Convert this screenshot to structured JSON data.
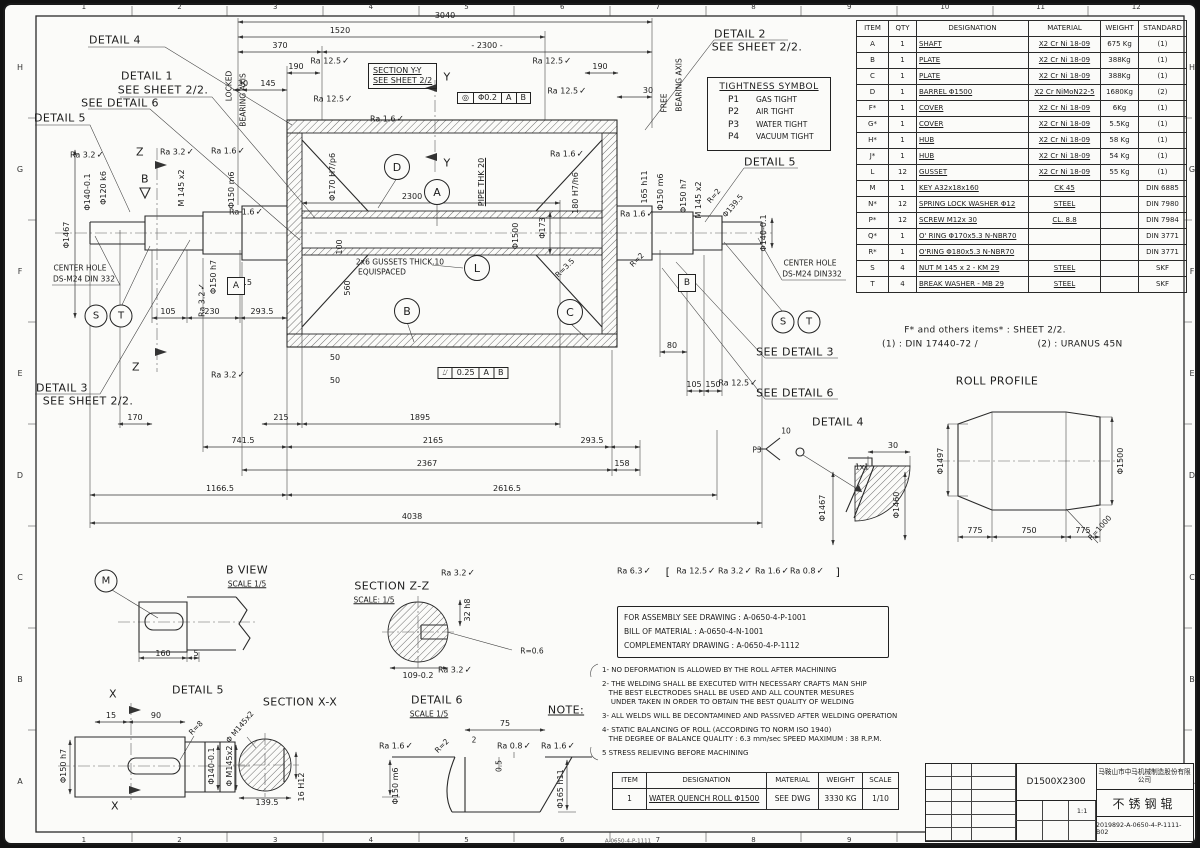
{
  "zones": {
    "cols": [
      "1",
      "2",
      "3",
      "4",
      "5",
      "6",
      "7",
      "8",
      "9",
      "10",
      "11",
      "12"
    ],
    "rows": [
      "H",
      "G",
      "F",
      "E",
      "D",
      "C",
      "B",
      "A"
    ]
  },
  "parts_table": {
    "headers": [
      "ITEM",
      "QTY",
      "DESIGNATION",
      "MATERIAL",
      "WEIGHT",
      "STANDARD"
    ],
    "rows": [
      [
        "A",
        "1",
        "SHAFT",
        "X2 Cr Ni 18-09",
        "675 Kg",
        "(1)"
      ],
      [
        "B",
        "1",
        "PLATE",
        "X2 Cr Ni 18-09",
        "388Kg",
        "(1)"
      ],
      [
        "C",
        "1",
        "PLATE",
        "X2 Cr Ni 18-09",
        "388Kg",
        "(1)"
      ],
      [
        "D",
        "1",
        "BARREL Φ1500",
        "X2 Cr NiMoN22-5",
        "1680Kg",
        "(2)"
      ],
      [
        "F*",
        "1",
        "COVER",
        "X2 Cr Ni 18-09",
        "6Kg",
        "(1)"
      ],
      [
        "G*",
        "1",
        "COVER",
        "X2 Cr Ni 18-09",
        "5.5Kg",
        "(1)"
      ],
      [
        "H*",
        "1",
        "HUB",
        "X2 Cr Ni 18-09",
        "58 Kg",
        "(1)"
      ],
      [
        "J*",
        "1",
        "HUB",
        "X2 Cr Ni 18-09",
        "54 Kg",
        "(1)"
      ],
      [
        "L",
        "12",
        "GUSSET",
        "X2 Cr Ni 18-09",
        "55 Kg",
        "(1)"
      ],
      [
        "M",
        "1",
        "KEY  A32x18x160",
        "CK 45",
        "",
        "DIN 6885"
      ],
      [
        "N*",
        "12",
        "SPRING LOCK WASHER Φ12",
        "STEEL",
        "",
        "DIN 7980"
      ],
      [
        "P*",
        "12",
        "SCREW M12x 30",
        "CL. 8.8",
        "",
        "DIN 7984"
      ],
      [
        "Q*",
        "1",
        "O' RING Φ170x5.3 N-NBR70",
        "",
        "",
        "DIN 3771"
      ],
      [
        "R*",
        "1",
        "O'RING Φ180x5.3 N-NBR70",
        "",
        "",
        "DIN 3771"
      ],
      [
        "S",
        "4",
        "NUT M 145 x 2 - KM 29",
        "STEEL",
        "",
        "SKF"
      ],
      [
        "T",
        "4",
        "BREAK WASHER - MB 29",
        "STEEL",
        "",
        "SKF"
      ]
    ]
  },
  "tightness": {
    "title": "TIGHTNESS SYMBOL",
    "items": [
      [
        "P1",
        "GAS TIGHT"
      ],
      [
        "P2",
        "AIR TIGHT"
      ],
      [
        "P3",
        "WATER TIGHT"
      ],
      [
        "P4",
        "VACUUM TIGHT"
      ]
    ]
  },
  "main_view": {
    "section_box": [
      "SECTION Y-Y",
      "SEE SHEET 2/2"
    ]
  },
  "assembly_box": {
    "lines": [
      "FOR ASSEMBLY SEE DRAWING : A-0650-4-P-1001",
      "BILL OF MATERIAL : A-0650-4-N-1001",
      "COMPLEMENTARY DRAWING : A-0650-4-P-1112"
    ]
  },
  "notes": {
    "paragraphs": [
      [
        "1- NO DEFORMATION IS ALLOWED BY THE ROLL AFTER MACHINING"
      ],
      [
        "2- THE WELDING SHALL BE EXECUTED WITH NECESSARY CRAFTS MAN SHIP",
        "   THE BEST ELECTRODES SHALL BE USED AND ALL COUNTER MESURES",
        "    UNDER TAKEN IN ORDER TO OBTAIN THE BEST QUALITY OF WELDING"
      ],
      [
        "3- ALL WELDS WILL BE DECONTAMINED AND PASSIVED AFTER WELDING OPERATION"
      ],
      [
        "4- STATIC BALANCING OF ROLL (ACCORDING TO NORM ISO 1940)",
        "   THE DEGREE OF BALANCE QUALITY : 6.3 mm/sec SPEED MAXIMUM : 38 R.P.M."
      ],
      [
        "5 STRESS RELIEVING BEFORE MACHINING"
      ]
    ]
  },
  "item_table": {
    "headers": [
      "ITEM",
      "DESIGNATION",
      "MATERIAL",
      "WEIGHT",
      "SCALE"
    ],
    "rows": [
      [
        "1",
        "WATER QUENCH ROLL Φ1500",
        "SEE DWG",
        "3330 KG",
        "1/10"
      ]
    ]
  },
  "title_block": {
    "company": "马鞍山市中马机械制造股份有限公司",
    "model": "D1500X2300",
    "product": "不锈钢辊",
    "number": "2019892-A-0650-4-P-1111-B02",
    "scale": "1:1"
  },
  "symbols": {
    "balloons": [
      {
        "t": "D",
        "x": 397,
        "y": 167
      },
      {
        "t": "A",
        "x": 437,
        "y": 192
      },
      {
        "t": "L",
        "x": 477,
        "y": 268
      },
      {
        "t": "B",
        "x": 407,
        "y": 311
      },
      {
        "t": "C",
        "x": 570,
        "y": 312
      },
      {
        "t": "S",
        "x": 96,
        "y": 316,
        "s": 1
      },
      {
        "t": "T",
        "x": 121,
        "y": 316,
        "s": 1
      },
      {
        "t": "S",
        "x": 783,
        "y": 322,
        "s": 1
      },
      {
        "t": "T",
        "x": 809,
        "y": 322,
        "s": 1
      },
      {
        "t": "M",
        "x": 106,
        "y": 581,
        "s": 1
      }
    ],
    "datums": [
      {
        "t": "A",
        "x": 236,
        "y": 286
      },
      {
        "t": "B",
        "x": 687,
        "y": 283
      }
    ],
    "frames": [
      {
        "cells": [
          "◎",
          "Φ0.2",
          "A",
          "B"
        ],
        "x": 494,
        "y": 98
      },
      {
        "cells": [
          "⌰",
          "0.25",
          "A",
          "B"
        ],
        "x": 473,
        "y": 373
      }
    ]
  },
  "annotations": [
    {
      "t": "DETAIL 4",
      "x": 115,
      "y": 40,
      "c": "lbl"
    },
    {
      "t": "DETAIL 1",
      "x": 147,
      "y": 76,
      "c": "lbl"
    },
    {
      "t": "SEE SHEET 2/2.",
      "x": 163,
      "y": 90,
      "c": "lbl"
    },
    {
      "t": "SEE DETAIL 6",
      "x": 120,
      "y": 103,
      "c": "lbl"
    },
    {
      "t": "DETAIL 5",
      "x": 60,
      "y": 118,
      "c": "lbl"
    },
    {
      "t": "DETAIL 3",
      "x": 62,
      "y": 388,
      "c": "lbl"
    },
    {
      "t": "SEE  SHEET 2/2.",
      "x": 88,
      "y": 401,
      "c": "lbl"
    },
    {
      "t": "LOCKED",
      "x": 229,
      "y": 86,
      "r": -90,
      "c": "sm"
    },
    {
      "t": "BEARING AXIS",
      "x": 243,
      "y": 100,
      "r": -90,
      "c": "sm"
    },
    {
      "t": "Z",
      "x": 140,
      "y": 152,
      "c": "lbl"
    },
    {
      "t": "Z",
      "x": 136,
      "y": 367,
      "c": "lbl"
    },
    {
      "t": "B",
      "x": 145,
      "y": 179,
      "c": "lbl"
    },
    {
      "t": "CENTER HOLE",
      "x": 80,
      "y": 268,
      "c": "sm"
    },
    {
      "t": "DS-M24 DIN 332",
      "x": 84,
      "y": 279,
      "c": "sm"
    },
    {
      "t": "DETAIL 2",
      "x": 740,
      "y": 34,
      "c": "lbl"
    },
    {
      "t": "SEE SHEET 2/2.",
      "x": 757,
      "y": 47,
      "c": "lbl"
    },
    {
      "t": "DETAIL 5",
      "x": 770,
      "y": 162,
      "c": "lbl"
    },
    {
      "t": "FREE",
      "x": 664,
      "y": 103,
      "r": -90,
      "c": "sm"
    },
    {
      "t": "BEARING AXIS",
      "x": 679,
      "y": 85,
      "r": -90,
      "c": "sm"
    },
    {
      "t": "CENTER HOLE",
      "x": 810,
      "y": 263,
      "c": "sm"
    },
    {
      "t": "DS-M24 DIN332",
      "x": 812,
      "y": 274,
      "c": "sm"
    },
    {
      "t": "SEE DETAIL 3",
      "x": 795,
      "y": 352,
      "c": "lbl"
    },
    {
      "t": "SEE DETAIL 6",
      "x": 795,
      "y": 393,
      "c": "lbl"
    },
    {
      "t": "3040",
      "x": 445,
      "y": 16
    },
    {
      "t": "1520",
      "x": 340,
      "y": 31
    },
    {
      "t": "370",
      "x": 280,
      "y": 46
    },
    {
      "t": "- 2300 -",
      "x": 487,
      "y": 46
    },
    {
      "t": "190",
      "x": 296,
      "y": 67
    },
    {
      "t": "190",
      "x": 600,
      "y": 67
    },
    {
      "t": "30",
      "x": 243,
      "y": 84
    },
    {
      "t": "145",
      "x": 268,
      "y": 84
    },
    {
      "t": "30",
      "x": 648,
      "y": 91
    },
    {
      "t": "Ra 12.5",
      "x": 330,
      "y": 62,
      "c": "ra"
    },
    {
      "t": "Ra 12.5",
      "x": 552,
      "y": 62,
      "c": "ra"
    },
    {
      "t": "Ra 12.5",
      "x": 333,
      "y": 100,
      "c": "ra"
    },
    {
      "t": "Ra 12.5",
      "x": 567,
      "y": 92,
      "c": "ra"
    },
    {
      "t": "Ra 1.6",
      "x": 387,
      "y": 120,
      "c": "ra"
    },
    {
      "t": "Ra 1.6",
      "x": 567,
      "y": 155,
      "c": "ra"
    },
    {
      "t": "Y",
      "x": 447,
      "y": 77,
      "c": "lbl"
    },
    {
      "t": "Y",
      "x": 447,
      "y": 163,
      "c": "lbl"
    },
    {
      "t": "Φ1467",
      "x": 67,
      "y": 235,
      "r": -90
    },
    {
      "t": "Φ140-0.1",
      "x": 88,
      "y": 192,
      "r": -90
    },
    {
      "t": "Φ120 k6",
      "x": 104,
      "y": 188,
      "r": -90
    },
    {
      "t": "M 145 x2",
      "x": 182,
      "y": 188,
      "r": -90
    },
    {
      "t": "Φ150 m6",
      "x": 232,
      "y": 190,
      "r": -90
    },
    {
      "t": "Φ150 h7",
      "x": 214,
      "y": 277,
      "r": -90
    },
    {
      "t": "Ra 3.2",
      "x": 87,
      "y": 156,
      "c": "ra"
    },
    {
      "t": "Ra 3.2",
      "x": 177,
      "y": 153,
      "c": "ra"
    },
    {
      "t": "Ra 1.6",
      "x": 228,
      "y": 152,
      "c": "ra"
    },
    {
      "t": "Ra 3.2",
      "x": 203,
      "y": 300,
      "r": -90,
      "c": "ra"
    },
    {
      "t": "Ra 1.6",
      "x": 246,
      "y": 213,
      "c": "ra"
    },
    {
      "t": "Φ170 H7/p6",
      "x": 333,
      "y": 177,
      "r": -90
    },
    {
      "t": "PIPE THK 20",
      "x": 482,
      "y": 182,
      "r": -90,
      "c": "u"
    },
    {
      "t": "Φ1500",
      "x": 516,
      "y": 236,
      "r": -90
    },
    {
      "t": "Φ173",
      "x": 543,
      "y": 228,
      "r": -90
    },
    {
      "t": "180 H7/h6",
      "x": 576,
      "y": 193,
      "r": -90
    },
    {
      "t": "165 h11",
      "x": 645,
      "y": 187,
      "r": -90
    },
    {
      "t": "Φ150 m6",
      "x": 661,
      "y": 192,
      "r": -90
    },
    {
      "t": "Φ150 h7",
      "x": 684,
      "y": 196,
      "r": -90
    },
    {
      "t": "M 145 x2",
      "x": 699,
      "y": 200,
      "r": -90
    },
    {
      "t": "R=2",
      "x": 714,
      "y": 196,
      "r": -50,
      "c": "sm"
    },
    {
      "t": "Φ139.5",
      "x": 733,
      "y": 206,
      "r": -50,
      "c": "sm"
    },
    {
      "t": "Φ140-0.1",
      "x": 764,
      "y": 233,
      "r": -90
    },
    {
      "t": "R=3.5",
      "x": 565,
      "y": 268,
      "r": -45,
      "c": "sm"
    },
    {
      "t": "R=2",
      "x": 637,
      "y": 260,
      "r": -45,
      "c": "sm"
    },
    {
      "t": "Ra 1.6",
      "x": 637,
      "y": 215,
      "c": "ra"
    },
    {
      "t": "2300",
      "x": 412,
      "y": 197
    },
    {
      "t": "36.5",
      "x": 243,
      "y": 283
    },
    {
      "t": "100",
      "x": 340,
      "y": 247,
      "r": -90
    },
    {
      "t": "560",
      "x": 348,
      "y": 288,
      "r": -90
    },
    {
      "t": "2x6 GUSSETS THICK.10",
      "x": 400,
      "y": 262,
      "c": "sm"
    },
    {
      "t": "EQUISPACED",
      "x": 382,
      "y": 272,
      "c": "sm"
    },
    {
      "t": "50",
      "x": 335,
      "y": 358
    },
    {
      "t": "50",
      "x": 335,
      "y": 381
    },
    {
      "t": "105",
      "x": 168,
      "y": 312
    },
    {
      "t": "230",
      "x": 212,
      "y": 312
    },
    {
      "t": "293.5",
      "x": 262,
      "y": 312
    },
    {
      "t": "170",
      "x": 135,
      "y": 418
    },
    {
      "t": "215",
      "x": 281,
      "y": 418
    },
    {
      "t": "1895",
      "x": 420,
      "y": 418
    },
    {
      "t": "741.5",
      "x": 243,
      "y": 441
    },
    {
      "t": "2165",
      "x": 433,
      "y": 441
    },
    {
      "t": "293.5",
      "x": 592,
      "y": 441
    },
    {
      "t": "2367",
      "x": 427,
      "y": 464
    },
    {
      "t": "158",
      "x": 622,
      "y": 464
    },
    {
      "t": "1166.5",
      "x": 220,
      "y": 489
    },
    {
      "t": "2616.5",
      "x": 507,
      "y": 489
    },
    {
      "t": "4038",
      "x": 412,
      "y": 517
    },
    {
      "t": "80",
      "x": 672,
      "y": 346
    },
    {
      "t": "105",
      "x": 694,
      "y": 385
    },
    {
      "t": "150",
      "x": 713,
      "y": 385
    },
    {
      "t": "Ra 12.5",
      "x": 738,
      "y": 384,
      "c": "ra"
    },
    {
      "t": "Ra 3.2",
      "x": 228,
      "y": 376,
      "c": "ra"
    },
    {
      "t": "Ra 6.3",
      "x": 634,
      "y": 572,
      "c": "ra"
    },
    {
      "t": "[",
      "x": 668,
      "y": 572,
      "c": "lbl"
    },
    {
      "t": "Ra 12.5",
      "x": 696,
      "y": 572,
      "c": "ra"
    },
    {
      "t": "Ra 3.2",
      "x": 735,
      "y": 572,
      "c": "ra"
    },
    {
      "t": "Ra 1.6",
      "x": 772,
      "y": 572,
      "c": "ra"
    },
    {
      "t": "Ra 0.8",
      "x": 807,
      "y": 572,
      "c": "ra"
    },
    {
      "t": "]",
      "x": 838,
      "y": 572,
      "c": "lbl"
    },
    {
      "t": "ROLL PROFILE",
      "x": 997,
      "y": 381,
      "c": "lbl"
    },
    {
      "t": "Φ1497",
      "x": 941,
      "y": 461,
      "r": -90
    },
    {
      "t": "Φ1500",
      "x": 1121,
      "y": 461,
      "r": -90
    },
    {
      "t": "775",
      "x": 975,
      "y": 531
    },
    {
      "t": "750",
      "x": 1029,
      "y": 531
    },
    {
      "t": "775",
      "x": 1083,
      "y": 531
    },
    {
      "t": "R=1000",
      "x": 1100,
      "y": 528,
      "r": -48,
      "c": "sm"
    },
    {
      "t": "DETAIL 4",
      "x": 838,
      "y": 422,
      "c": "lbl"
    },
    {
      "t": "P3",
      "x": 757,
      "y": 450,
      "c": "sm"
    },
    {
      "t": "10",
      "x": 786,
      "y": 431,
      "c": "sm"
    },
    {
      "t": "30",
      "x": 893,
      "y": 446
    },
    {
      "t": "1x1",
      "x": 862,
      "y": 467,
      "c": "sm"
    },
    {
      "t": "Φ1467",
      "x": 823,
      "y": 508,
      "r": -90
    },
    {
      "t": "Φ1460",
      "x": 897,
      "y": 505,
      "r": -90
    },
    {
      "t": "B VIEW",
      "x": 247,
      "y": 570,
      "c": "lbl"
    },
    {
      "t": "SCALE 1/5",
      "x": 247,
      "y": 584,
      "c": "smu"
    },
    {
      "t": "160",
      "x": 163,
      "y": 654
    },
    {
      "t": "5",
      "x": 196,
      "y": 654
    },
    {
      "t": "SECTION Z-Z",
      "x": 392,
      "y": 586,
      "c": "lbl"
    },
    {
      "t": "SCALE: 1/5",
      "x": 374,
      "y": 600,
      "c": "smu"
    },
    {
      "t": "Ra 3.2",
      "x": 458,
      "y": 574,
      "c": "ra"
    },
    {
      "t": "32 h8",
      "x": 468,
      "y": 610,
      "r": -90
    },
    {
      "t": "R=0.6",
      "x": 532,
      "y": 651,
      "c": "sm"
    },
    {
      "t": "109-0.2",
      "x": 418,
      "y": 676
    },
    {
      "t": "Ra 3.2",
      "x": 455,
      "y": 671,
      "c": "ra"
    },
    {
      "t": "DETAIL 5",
      "x": 198,
      "y": 690,
      "c": "lbl"
    },
    {
      "t": "X",
      "x": 113,
      "y": 694,
      "c": "lbl"
    },
    {
      "t": "X",
      "x": 115,
      "y": 806,
      "c": "lbl"
    },
    {
      "t": "15",
      "x": 111,
      "y": 716
    },
    {
      "t": "90",
      "x": 156,
      "y": 716
    },
    {
      "t": "R=8",
      "x": 196,
      "y": 728,
      "r": -45,
      "c": "sm"
    },
    {
      "t": "Φ150 h7",
      "x": 64,
      "y": 766,
      "r": -90
    },
    {
      "t": "Φ140-0.1",
      "x": 212,
      "y": 766,
      "r": -90
    },
    {
      "t": "Φ M145x2",
      "x": 230,
      "y": 766,
      "r": -90
    },
    {
      "t": "SECTION X-X",
      "x": 300,
      "y": 702,
      "c": "lbl"
    },
    {
      "t": "Φ M145x2",
      "x": 240,
      "y": 727,
      "r": -50,
      "c": "sm"
    },
    {
      "t": "139.5",
      "x": 267,
      "y": 803
    },
    {
      "t": "16 H12",
      "x": 302,
      "y": 787,
      "r": -90
    },
    {
      "t": "DETAIL 6",
      "x": 437,
      "y": 700,
      "c": "lbl"
    },
    {
      "t": "SCALE 1/5",
      "x": 429,
      "y": 714,
      "c": "smu"
    },
    {
      "t": "75",
      "x": 505,
      "y": 724
    },
    {
      "t": "2",
      "x": 474,
      "y": 740,
      "c": "sm"
    },
    {
      "t": "R=2",
      "x": 442,
      "y": 746,
      "r": -45,
      "c": "sm"
    },
    {
      "t": "Ra 0.8",
      "x": 514,
      "y": 747,
      "c": "ra"
    },
    {
      "t": "Ra 1.6",
      "x": 396,
      "y": 747,
      "c": "ra"
    },
    {
      "t": "Ra 1.6",
      "x": 558,
      "y": 747,
      "c": "ra"
    },
    {
      "t": "0.5",
      "x": 499,
      "y": 766,
      "r": -90,
      "c": "sm"
    },
    {
      "t": "Φ150 m6",
      "x": 396,
      "y": 786,
      "r": -90
    },
    {
      "t": "Φ165 h11",
      "x": 561,
      "y": 789,
      "r": -90
    },
    {
      "t": "NOTE:",
      "x": 566,
      "y": 710,
      "c": "lbl u"
    },
    {
      "t": "F* and others items* : SHEET 2/2.",
      "x": 985,
      "y": 331,
      "c": "lbl2"
    },
    {
      "t": "(1) :  DIN 17440-72 /",
      "x": 930,
      "y": 345,
      "c": "lbl2"
    },
    {
      "t": "(2) : URANUS 45N",
      "x": 1080,
      "y": 345,
      "c": "lbl2"
    },
    {
      "t": "A-0650-4-P-1111",
      "x": 628,
      "y": 842,
      "c": "micro"
    }
  ]
}
